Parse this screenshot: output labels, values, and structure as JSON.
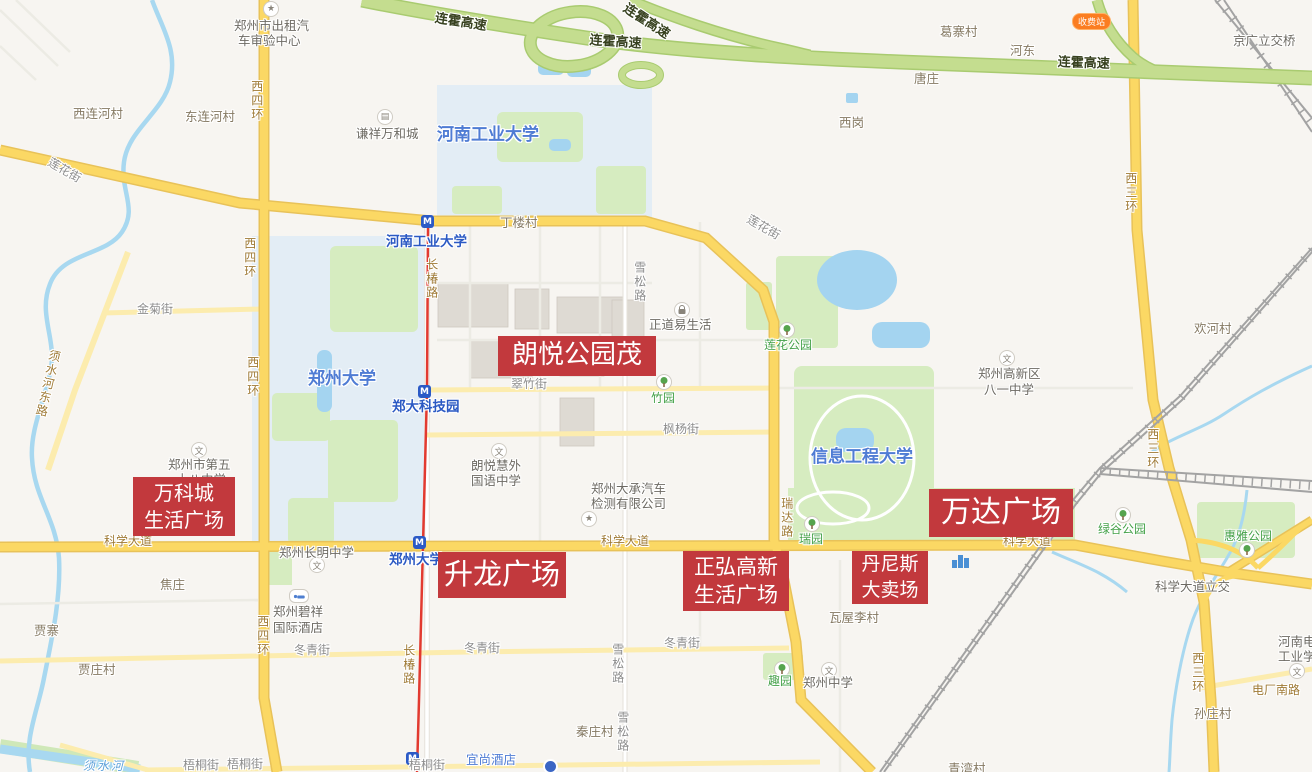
{
  "map": {
    "colors": {
      "landmark_red": "#c2393d",
      "arterial_road": "#fbd864",
      "highway_green": "#c4dd8f",
      "water_blue": "#a4d4f0",
      "campus_blue": "#e3edf5",
      "park_green": "#d6ecc0",
      "metro_line_red": "#e23a30",
      "toll_orange": "#fb7d21"
    },
    "toll_badge": "收费站",
    "landmarks": [
      {
        "id": "wankecheng-life-plaza",
        "lines": [
          "万科城",
          "生活广场"
        ]
      },
      {
        "id": "langyue-park-mall",
        "lines": [
          "朗悦公园茂"
        ]
      },
      {
        "id": "shenglong-plaza",
        "lines": [
          "升龙广场"
        ]
      },
      {
        "id": "zhenghong-gaoxin-life-plaza",
        "lines": [
          "正弘高新",
          "生活广场"
        ]
      },
      {
        "id": "dennis-hypermarket",
        "lines": [
          "丹尼斯",
          "大卖场"
        ]
      },
      {
        "id": "wanda-plaza",
        "lines": [
          "万达广场"
        ]
      }
    ],
    "labels": [
      {
        "id": "hwy-lianhuo-1",
        "type": "hwy",
        "x": 436,
        "y": 12,
        "rot": 9,
        "text": "连霍高速"
      },
      {
        "id": "hwy-lianhuo-2",
        "type": "hwy",
        "x": 590,
        "y": 34,
        "rot": 4,
        "text": "连霍高速"
      },
      {
        "id": "hwy-lianhuo-3",
        "type": "hwy",
        "x": 628,
        "y": 2,
        "rot": 33,
        "text": "连霍高速"
      },
      {
        "id": "hwy-lianhuo-4",
        "type": "hwy",
        "x": 1058,
        "y": 56,
        "rot": 2,
        "text": "连霍高速"
      },
      {
        "id": "poi-taxi-center-line1",
        "type": "poi",
        "x": 234,
        "y": 19,
        "text": "郑州市出租汽"
      },
      {
        "id": "poi-taxi-center-line2",
        "type": "poi",
        "x": 238,
        "y": 34,
        "text": "车审验中心"
      },
      {
        "id": "village-xilianhecun",
        "type": "village",
        "x": 73,
        "y": 107,
        "text": "西连河村"
      },
      {
        "id": "village-donglianhecun",
        "type": "village",
        "x": 185,
        "y": 110,
        "text": "东连河村"
      },
      {
        "id": "poi-qianxiang-wanhecheng",
        "type": "poi",
        "x": 356,
        "y": 127,
        "text": "谦祥万和城"
      },
      {
        "id": "uni-henan-gongye-daxue",
        "type": "uni",
        "x": 437,
        "y": 126,
        "text": "河南工业大学"
      },
      {
        "id": "village-dinglou",
        "type": "village",
        "x": 500,
        "y": 216,
        "text": "丁楼村"
      },
      {
        "id": "village-xigang",
        "type": "village",
        "x": 839,
        "y": 116,
        "text": "西岗"
      },
      {
        "id": "village-tangzhuang",
        "type": "village",
        "x": 914,
        "y": 72,
        "text": "唐庄"
      },
      {
        "id": "village-gezhai",
        "type": "village",
        "x": 940,
        "y": 25,
        "text": "葛寨村"
      },
      {
        "id": "village-hedong",
        "type": "village",
        "x": 1010,
        "y": 44,
        "text": "河东"
      },
      {
        "id": "poi-jingguang-bridge",
        "type": "poi",
        "x": 1233,
        "y": 34,
        "text": "京广立交桥"
      },
      {
        "id": "road-xisihuan-1",
        "type": "roadname",
        "v": true,
        "x": 249,
        "y": 80,
        "text": "西四环"
      },
      {
        "id": "road-xisihuan-2",
        "type": "roadname",
        "v": true,
        "x": 242,
        "y": 237,
        "text": "西四环"
      },
      {
        "id": "road-xisihuan-3",
        "type": "roadname",
        "v": true,
        "x": 245,
        "y": 356,
        "text": "西四环"
      },
      {
        "id": "road-xisihuan-4",
        "type": "roadname",
        "v": true,
        "x": 255,
        "y": 615,
        "text": "西四环"
      },
      {
        "id": "road-xisanhuan-1",
        "type": "roadname",
        "v": true,
        "x": 1123,
        "y": 172,
        "text": "西三环"
      },
      {
        "id": "road-xisanhuan-2",
        "type": "roadname",
        "v": true,
        "x": 1145,
        "y": 428,
        "text": "西三环"
      },
      {
        "id": "road-xisanhuan-3",
        "type": "roadname",
        "v": true,
        "x": 1190,
        "y": 652,
        "text": "西三环"
      },
      {
        "id": "street-lianhuajie-1",
        "type": "street",
        "x": 52,
        "y": 156,
        "rot": 30,
        "text": "莲花街"
      },
      {
        "id": "street-lianhuajie-2",
        "type": "street",
        "x": 751,
        "y": 213,
        "rot": 30,
        "text": "莲花街"
      },
      {
        "id": "street-jinjujie",
        "type": "street",
        "x": 137,
        "y": 303,
        "text": "金菊街"
      },
      {
        "id": "road-xushuihedonglu",
        "type": "roadname",
        "v": true,
        "x": 48,
        "y": 348,
        "rot": 13,
        "text": "须水河东路"
      },
      {
        "id": "road-changchunlu-1",
        "type": "roadname",
        "v": true,
        "x": 424,
        "y": 258,
        "text": "长椿路"
      },
      {
        "id": "road-changchunlu-2",
        "type": "roadname",
        "v": true,
        "x": 401,
        "y": 644,
        "text": "长椿路"
      },
      {
        "id": "metro-henan-gongye-daxue",
        "type": "metrostation",
        "x": 386,
        "y": 235,
        "text": "河南工业大学"
      },
      {
        "id": "metro-zhengda-kejiyuan",
        "type": "metrostation",
        "x": 392,
        "y": 400,
        "text": "郑大科技园"
      },
      {
        "id": "metro-zhengzhou-daxue",
        "type": "metrostation",
        "x": 389,
        "y": 553,
        "text": "郑州大学"
      },
      {
        "id": "uni-zhengzhou-daxue",
        "type": "uni",
        "x": 308,
        "y": 370,
        "text": "郑州大学"
      },
      {
        "id": "uni-xinxi-gongcheng-daxue",
        "type": "uni",
        "x": 811,
        "y": 448,
        "text": "信息工程大学"
      },
      {
        "id": "street-xuesonglu-1",
        "type": "street",
        "v": true,
        "x": 632,
        "y": 261,
        "text": "雪松路"
      },
      {
        "id": "street-xuesonglu-2",
        "type": "street",
        "v": true,
        "x": 610,
        "y": 643,
        "text": "雪松路"
      },
      {
        "id": "street-xuesonglu-3",
        "type": "street",
        "v": true,
        "x": 615,
        "y": 711,
        "text": "雪松路"
      },
      {
        "id": "poi-zhengdao-yishenghuo",
        "type": "poi",
        "x": 649,
        "y": 318,
        "text": "正道易生活"
      },
      {
        "id": "park-lianhua-gongyuan",
        "type": "park",
        "x": 764,
        "y": 339,
        "text": "莲花公园"
      },
      {
        "id": "park-zhuyuan",
        "type": "park",
        "x": 651,
        "y": 392,
        "text": "竹园"
      },
      {
        "id": "street-cuizhujie",
        "type": "street",
        "x": 511,
        "y": 378,
        "text": "翠竹街"
      },
      {
        "id": "street-fengyangjie",
        "type": "street",
        "x": 663,
        "y": 423,
        "text": "枫杨街"
      },
      {
        "id": "poi-bayi-zhongxue-line1",
        "type": "poi",
        "x": 978,
        "y": 367,
        "text": "郑州高新区"
      },
      {
        "id": "poi-bayi-zhongxue-line2",
        "type": "poi",
        "x": 984,
        "y": 383,
        "text": "八一中学"
      },
      {
        "id": "village-huanhecun",
        "type": "village",
        "x": 1194,
        "y": 322,
        "text": "欢河村"
      },
      {
        "id": "poi-langyuehui-line1",
        "type": "poi",
        "x": 471,
        "y": 459,
        "text": "朗悦慧外"
      },
      {
        "id": "poi-langyuehui-line2",
        "type": "poi",
        "x": 471,
        "y": 474,
        "text": "国语中学"
      },
      {
        "id": "poi-no58-school-line1",
        "type": "poi",
        "x": 168,
        "y": 458,
        "text": "郑州市第五"
      },
      {
        "id": "poi-no58-school-line2",
        "type": "poi",
        "x": 176,
        "y": 473,
        "text": "十八中学"
      },
      {
        "id": "poi-dacheng-auto-line1",
        "type": "poi",
        "x": 591,
        "y": 482,
        "text": "郑州大承汽车"
      },
      {
        "id": "poi-dacheng-auto-line2",
        "type": "poi",
        "x": 591,
        "y": 497,
        "text": "检测有限公司"
      },
      {
        "id": "road-ruidalu",
        "type": "roadname",
        "v": true,
        "x": 779,
        "y": 497,
        "text": "瑞达路"
      },
      {
        "id": "road-kexuedadao-1",
        "type": "roadname",
        "x": 104,
        "y": 535,
        "text": "科学大道"
      },
      {
        "id": "road-kexuedadao-2",
        "type": "roadname",
        "x": 601,
        "y": 535,
        "text": "科学大道"
      },
      {
        "id": "road-kexuedadao-3",
        "type": "roadname",
        "x": 1003,
        "y": 535,
        "text": "科学大道"
      },
      {
        "id": "park-ruiyuan",
        "type": "park",
        "x": 799,
        "y": 533,
        "text": "瑞园"
      },
      {
        "id": "park-lvgu-gongyuan",
        "type": "park",
        "x": 1098,
        "y": 523,
        "text": "绿谷公园"
      },
      {
        "id": "park-huiya-gongyuan",
        "type": "park",
        "x": 1224,
        "y": 530,
        "text": "惠雅公园"
      },
      {
        "id": "poi-kexuedadao-lijiao",
        "type": "poi",
        "x": 1155,
        "y": 580,
        "text": "科学大道立交"
      },
      {
        "id": "poi-changming-zhongxue",
        "type": "poi",
        "x": 279,
        "y": 546,
        "text": "郑州长明中学"
      },
      {
        "id": "poi-bixiang-hotel-line1",
        "type": "poi",
        "x": 273,
        "y": 605,
        "text": "郑州碧祥"
      },
      {
        "id": "poi-bixiang-hotel-line2",
        "type": "poi",
        "x": 273,
        "y": 621,
        "text": "国际酒店"
      },
      {
        "id": "village-jiaozhuang",
        "type": "village",
        "x": 160,
        "y": 578,
        "text": "焦庄"
      },
      {
        "id": "village-jiazhai",
        "type": "village",
        "x": 34,
        "y": 624,
        "text": "贾寨"
      },
      {
        "id": "village-jiazhuangcun",
        "type": "village",
        "x": 78,
        "y": 663,
        "text": "贾庄村"
      },
      {
        "id": "village-wawulicun",
        "type": "village",
        "x": 829,
        "y": 611,
        "text": "瓦屋李村"
      },
      {
        "id": "street-dongqingjie-1",
        "type": "street",
        "x": 294,
        "y": 644,
        "text": "冬青街"
      },
      {
        "id": "street-dongqingjie-2",
        "type": "street",
        "x": 464,
        "y": 642,
        "text": "冬青街"
      },
      {
        "id": "street-dongqingjie-3",
        "type": "street",
        "x": 664,
        "y": 637,
        "text": "冬青街"
      },
      {
        "id": "park-quyuan",
        "type": "park",
        "x": 768,
        "y": 675,
        "text": "趣园"
      },
      {
        "id": "poi-zhengzhou-zhongxue",
        "type": "poi",
        "x": 803,
        "y": 676,
        "text": "郑州中学"
      },
      {
        "id": "village-qinzhuangcun",
        "type": "village",
        "x": 576,
        "y": 725,
        "text": "秦庄村"
      },
      {
        "id": "village-sunzhuangcun",
        "type": "village",
        "x": 1194,
        "y": 707,
        "text": "孙庄村"
      },
      {
        "id": "road-dianchangnanlu",
        "type": "roadname",
        "x": 1252,
        "y": 684,
        "text": "电厂南路"
      },
      {
        "id": "poi-henan-dianli-line1",
        "type": "poi",
        "x": 1278,
        "y": 635,
        "text": "河南电"
      },
      {
        "id": "poi-henan-dianli-line2",
        "type": "poi",
        "x": 1278,
        "y": 650,
        "text": "工业学"
      },
      {
        "id": "street-wutongjie-1",
        "type": "street",
        "x": 183,
        "y": 759,
        "text": "梧桐街"
      },
      {
        "id": "street-wutongjie-2",
        "type": "street",
        "x": 227,
        "y": 758,
        "text": "梧桐街"
      },
      {
        "id": "street-wutongjie-3",
        "type": "street",
        "x": 409,
        "y": 759,
        "text": "梧桐街"
      },
      {
        "id": "poi-yishang-hotel",
        "type": "hotelname",
        "x": 466,
        "y": 753,
        "text": "宜尚酒店"
      },
      {
        "id": "river-xushuihe",
        "type": "rivername",
        "x": 83,
        "y": 760,
        "text": "须水河"
      },
      {
        "id": "village-qingwancun",
        "type": "village",
        "x": 948,
        "y": 762,
        "text": "青湾村"
      }
    ],
    "icons": [
      {
        "id": "star-icon-1",
        "g": "star",
        "x": 263,
        "y": 1
      },
      {
        "id": "building-icon",
        "g": "building",
        "x": 377,
        "y": 109
      },
      {
        "id": "metro-icon-1",
        "g": "metro",
        "x": 421,
        "y": 215
      },
      {
        "id": "metro-icon-2",
        "g": "metro",
        "x": 418,
        "y": 385
      },
      {
        "id": "metro-icon-3",
        "g": "metro",
        "x": 413,
        "y": 536
      },
      {
        "id": "metro-icon-4",
        "g": "metro",
        "x": 406,
        "y": 752
      },
      {
        "id": "school-icon-bayi",
        "g": "school",
        "x": 999,
        "y": 350
      },
      {
        "id": "school-icon-langyuehui",
        "g": "school",
        "x": 491,
        "y": 443
      },
      {
        "id": "school-icon-no58",
        "g": "school",
        "x": 191,
        "y": 442
      },
      {
        "id": "school-icon-changming",
        "g": "school",
        "x": 309,
        "y": 557
      },
      {
        "id": "school-icon-zhengzhou",
        "g": "school",
        "x": 821,
        "y": 662
      },
      {
        "id": "school-icon-dianli",
        "g": "school",
        "x": 1289,
        "y": 663
      },
      {
        "id": "bag-icon",
        "g": "bag",
        "x": 674,
        "y": 302
      },
      {
        "id": "tree-icon-lianhua",
        "g": "tree",
        "x": 779,
        "y": 322
      },
      {
        "id": "tree-icon-zhuyuan",
        "g": "tree",
        "x": 656,
        "y": 374
      },
      {
        "id": "tree-icon-ruiyuan",
        "g": "tree",
        "x": 804,
        "y": 516
      },
      {
        "id": "tree-icon-quyuan",
        "g": "tree",
        "x": 774,
        "y": 661
      },
      {
        "id": "tree-icon-lvgu",
        "g": "tree",
        "x": 1115,
        "y": 507
      },
      {
        "id": "tree-icon-huiya",
        "g": "tree",
        "x": 1239,
        "y": 542
      },
      {
        "id": "hotel-icon",
        "g": "hotel",
        "x": 289,
        "y": 589
      },
      {
        "id": "star-icon-2",
        "g": "star",
        "x": 581,
        "y": 511
      },
      {
        "id": "bars-icon",
        "g": "bars",
        "x": 951,
        "y": 549
      },
      {
        "id": "dot-icon",
        "g": "dot",
        "x": 543,
        "y": 759
      }
    ]
  }
}
